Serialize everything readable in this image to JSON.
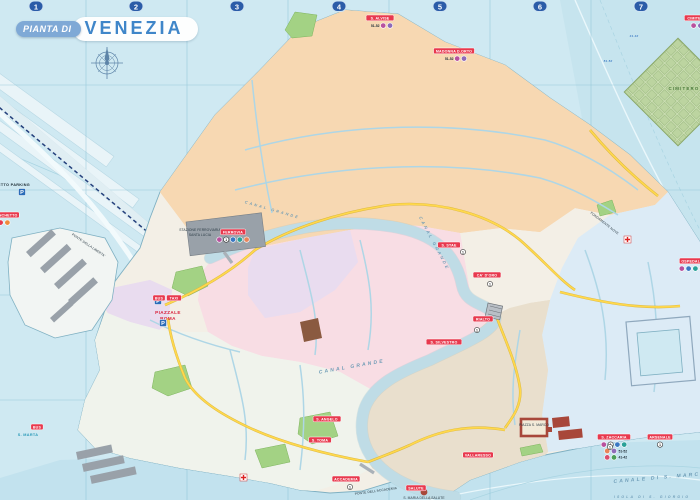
{
  "title": {
    "prefix": "PIANTA DI",
    "name": "VENEZIA"
  },
  "grid": {
    "columns": [
      "1",
      "2",
      "3",
      "4",
      "5",
      "6",
      "7"
    ],
    "column_x": [
      36,
      136,
      237,
      339,
      440,
      540,
      641
    ],
    "line_x": [
      86,
      187,
      288,
      389,
      490,
      591
    ],
    "line_y": [
      85,
      190,
      295,
      400
    ]
  },
  "colors": {
    "water": "#cfe9f2",
    "water_line": "#a9d4e2",
    "coast": "#7fb0c2",
    "land": "#f3efe6",
    "cannaregio": "#eda257",
    "cannaregio_bg": "#f7d8b2",
    "san_polo": "#efa8bc",
    "san_polo_bg": "#f8dde4",
    "santa_croce": "#c79fd4",
    "santa_croce_bg": "#e9dcef",
    "castello": "#8fc0e4",
    "castello_bg": "#dcebf6",
    "san_marco": "#c0a98b",
    "san_marco_bg": "#e9dfcd",
    "dorsoduro": "#d9e4d2",
    "dorsoduro_bg": "#f0f3ec",
    "park": "#a3d284",
    "gray_buildings": "#99a1a9",
    "landmark_red": "#a8473a",
    "road_yellow": "#ffd84d",
    "rail_blue": "#24407c",
    "stop_red": "#e8394e",
    "grid_badge": "#2b5ca8",
    "title_blue": "#3f86c9",
    "title_pill": "#7fa9d6"
  },
  "vaporetto_stops": [
    {
      "name": "TRONCHETTO",
      "x": 4,
      "y": 215,
      "rows": [
        [
          {
            "c": "#e8394e"
          },
          {
            "c": "#f08a3c"
          }
        ]
      ]
    },
    {
      "name": "FERROVIA",
      "x": 233,
      "y": 232,
      "rows": [
        [
          {
            "c": "#b8519e"
          },
          {
            "c": "#fff",
            "t1": "1"
          },
          {
            "c": "#3a78c3"
          },
          {
            "c": "#2aa198"
          },
          {
            "c": "#e8845a"
          }
        ]
      ]
    },
    {
      "name": "S. ALVISE",
      "x": 380,
      "y": 18,
      "rows": [
        [
          {
            "t": "51-52"
          },
          {
            "c": "#b8519e"
          },
          {
            "c": "#8e6ab8"
          }
        ]
      ]
    },
    {
      "name": "MADONNA D.ORTO",
      "x": 454,
      "y": 51,
      "rows": [
        [
          {
            "t": "51-52"
          },
          {
            "c": "#b8519e"
          },
          {
            "c": "#8e6ab8"
          }
        ]
      ]
    },
    {
      "name": "CIMITERO",
      "x": 697,
      "y": 18,
      "rows": [
        [
          {
            "c": "#b8519e"
          },
          {
            "c": "#8e6ab8"
          }
        ]
      ]
    },
    {
      "name": "OSPEDALE",
      "x": 692,
      "y": 261,
      "rows": [
        [
          {
            "c": "#b8519e"
          },
          {
            "c": "#3a78c3"
          },
          {
            "c": "#2aa198"
          },
          {
            "c": "#e8845a"
          }
        ]
      ]
    },
    {
      "name": "S. STAE",
      "x": 449,
      "y": 245,
      "rows": []
    },
    {
      "name": "CA' D'ORO",
      "x": 487,
      "y": 275,
      "rows": []
    },
    {
      "name": "RIALTO",
      "x": 483,
      "y": 319,
      "rows": []
    },
    {
      "name": "S. SILVESTRO",
      "x": 444,
      "y": 342,
      "rows": []
    },
    {
      "name": "S. ANGELO",
      "x": 327,
      "y": 419,
      "rows": []
    },
    {
      "name": "S. TOMA",
      "x": 320,
      "y": 440,
      "rows": []
    },
    {
      "name": "ACCADEMIA",
      "x": 346,
      "y": 479,
      "rows": []
    },
    {
      "name": "SALUTE",
      "x": 416,
      "y": 488,
      "rows": []
    },
    {
      "name": "VALLARESSO",
      "x": 478,
      "y": 455,
      "rows": []
    },
    {
      "name": "S. ZACCARIA",
      "x": 614,
      "y": 437,
      "rows": [
        [
          {
            "c": "#b8519e"
          },
          {
            "c": "#fff",
            "t1": "1"
          },
          {
            "c": "#3a78c3"
          },
          {
            "c": "#2aa198"
          }
        ],
        [
          {
            "c": "#e8845a"
          },
          {
            "c": "#8e6ab8"
          },
          {
            "t": "51-52"
          }
        ],
        [
          {
            "c": "#d94f6e"
          },
          {
            "c": "#4a9e58"
          },
          {
            "t": "41-42"
          }
        ]
      ]
    },
    {
      "name": "ARSENALE",
      "x": 660,
      "y": 437,
      "rows": [
        [
          {
            "c": "#fff",
            "t1": "1"
          }
        ]
      ]
    }
  ],
  "red_pills": [
    {
      "t": "BUS",
      "x": 159,
      "y": 298
    },
    {
      "t": "TAXI",
      "x": 174,
      "y": 298
    },
    {
      "t": "BUS",
      "x": 37,
      "y": 427
    }
  ],
  "line1_markers": [
    {
      "x": 463,
      "y": 252
    },
    {
      "x": 490,
      "y": 284
    },
    {
      "x": 477,
      "y": 330
    },
    {
      "x": 350,
      "y": 487
    },
    {
      "x": 610,
      "y": 447
    }
  ],
  "labels": [
    {
      "t": "TRONCHETTO PARKING",
      "x": 30,
      "y": 186,
      "cls": "place",
      "anchor": "end"
    },
    {
      "t": "STAZIONE FERROVIARIA",
      "x": 200,
      "y": 231,
      "cls": "tiny"
    },
    {
      "t": "SANTA LUCIA",
      "x": 200,
      "y": 236,
      "cls": "tiny"
    },
    {
      "t": "PIAZZALE",
      "x": 168,
      "y": 314,
      "cls": "red"
    },
    {
      "t": "ROMA",
      "x": 168,
      "y": 320,
      "cls": "red"
    },
    {
      "t": "CIMITERO",
      "x": 684,
      "y": 90,
      "cls": "green"
    },
    {
      "t": "FONDAMENTE NOVE",
      "x": 604,
      "y": 224,
      "cls": "tiny",
      "rot": 38
    },
    {
      "t": "S. MARTA",
      "x": 28,
      "y": 436,
      "cls": "cyan"
    },
    {
      "t": "PONTE DELLA LIBERTA'",
      "x": 88,
      "y": 246,
      "cls": "tiny",
      "rot": 34
    },
    {
      "t": "PIAZZA S. MARCO",
      "x": 534,
      "y": 426,
      "cls": "tiny"
    },
    {
      "t": "PONTE DELL'ACCADEMIA",
      "x": 376,
      "y": 492,
      "cls": "tiny",
      "rot": -8
    },
    {
      "t": "S. MARIA DELLA SALUTE",
      "x": 424,
      "y": 499,
      "cls": "tiny"
    }
  ],
  "water_labels": [
    {
      "t": "CANAL GRANDE",
      "x": 272,
      "y": 211,
      "rot": 16,
      "size": 3.8
    },
    {
      "t": "CANAL GRANDE",
      "x": 433,
      "y": 244,
      "rot": 62,
      "size": 4.2
    },
    {
      "t": "CANAL GRANDE",
      "x": 352,
      "y": 368,
      "rot": -10,
      "size": 5
    },
    {
      "t": "CANALE DI S. MARCO",
      "x": 660,
      "y": 479,
      "rot": -5,
      "size": 5
    },
    {
      "t": "ISOLA DI S. GIORGIO",
      "x": 652,
      "y": 498,
      "rot": 0,
      "size": 3.4
    },
    {
      "t": "41-42",
      "x": 634,
      "y": 37,
      "rot": 0,
      "size": 3,
      "note": true
    },
    {
      "t": "51-52",
      "x": 608,
      "y": 62,
      "rot": 0,
      "size": 3,
      "note": true
    }
  ],
  "parking_icons": [
    {
      "x": 22,
      "y": 192
    },
    {
      "x": 158,
      "y": 301
    },
    {
      "x": 163,
      "y": 323
    }
  ]
}
